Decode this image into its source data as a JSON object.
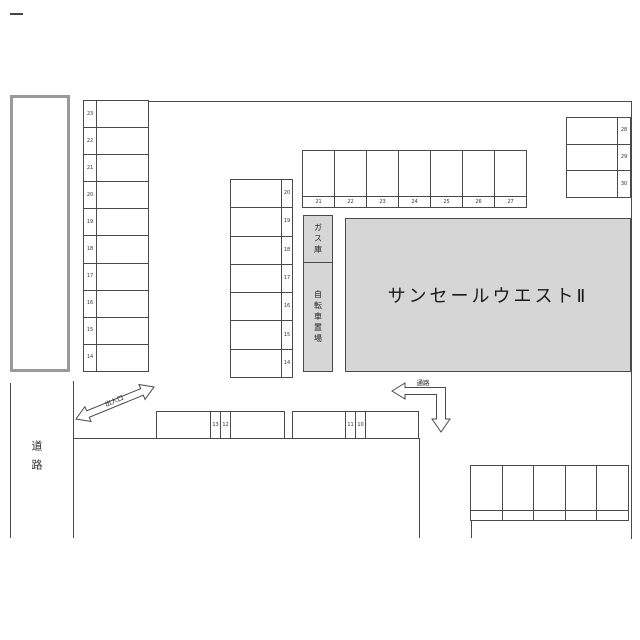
{
  "diagram": {
    "building_label": "サンセールウエストⅡ",
    "gas_label": "ガス庫",
    "bicycle_label": "自転車置場",
    "road_label": "道路",
    "entrance_label": "出入口",
    "passage_label": "通路"
  },
  "lots": {
    "left_column": [
      "23",
      "22",
      "21",
      "20",
      "19",
      "18",
      "17",
      "16",
      "15",
      "14"
    ],
    "middle_column": [
      "20",
      "19",
      "18",
      "17",
      "16",
      "15",
      "14"
    ],
    "top_row": [
      "21",
      "22",
      "23",
      "24",
      "25",
      "26",
      "27"
    ],
    "right_column": [
      "28",
      "29",
      "30"
    ],
    "bottom_left_strip": [
      "13",
      "12"
    ],
    "bottom_right_strip": [
      "11",
      "10"
    ],
    "bottom_far_right_cells": 5
  },
  "colors": {
    "line": "#4a4a4a",
    "area_fill": "#d6d6d6",
    "thick_border": "#9a9a9a",
    "text": "#1a1a1a"
  }
}
